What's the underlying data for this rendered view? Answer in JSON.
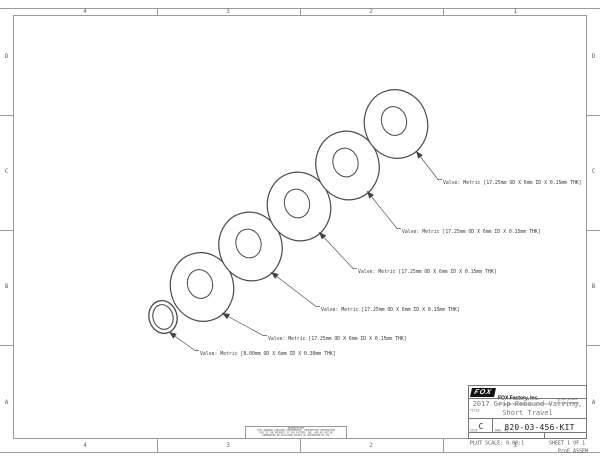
{
  "colors": {
    "line": "#9a9a9a",
    "ink": "#3a3a3a",
    "title_gray": "#7b7b7b"
  },
  "drawing": {
    "zones": {
      "cols": [
        "4",
        "3",
        "2",
        "1"
      ],
      "rows": [
        "D",
        "C",
        "B",
        "A"
      ]
    },
    "callouts": [
      {
        "label": "Valve: Metric [17.25mm OD X 6mm ID X 0.15mm THK]"
      },
      {
        "label": "Valve: Metric [17.25mm OD X 6mm ID X 0.15mm THK]"
      },
      {
        "label": "Valve: Metric [17.25mm OD X 6mm ID X 0.15mm THK]"
      },
      {
        "label": "Valve: Metric [17.25mm OD X 6mm ID X 0.15mm THK]"
      },
      {
        "label": "Valve: Metric [17.25mm OD X 6mm ID X 0.15mm THK]"
      },
      {
        "label": "Valve: Metric [8.00mm OD X 6mm ID X 0.30mm THK]"
      }
    ]
  },
  "title_block": {
    "logo_text": "FOX",
    "company": "FOX Factory, Inc.",
    "address": "130 Hangar Way, Watsonville, CA 95076 USA",
    "phone": "Ph 831-768-1100",
    "fax": "Fax 831-768-9342",
    "title_label": "TITLE",
    "title_line1": "2017 Grip Rebound Valving,",
    "title_line2": "Short Travel",
    "size_label": "SIZE",
    "size": "C",
    "dwg_label": "DWG. NO.",
    "dwg_no": "820-03-456-KIT",
    "plot_scale": "PLOT SCALE: 0.08:1",
    "sheet": "SHEET 1 OF 1"
  },
  "proprietary": {
    "heading": "PROPRIETARY",
    "lines": [
      "THIS DRAWING CONTAINS CONFIDENTIAL, PROPRIETARY INFORMATION",
      "THAT IS THE PROPERTY OF FOX FACTORY, INC. AND MAY NOT BE",
      "REPRODUCED OR DISCLOSED EXCEPT AS AUTHORIZED BY FOX"
    ]
  },
  "footer_note": "ProE ASSEM"
}
